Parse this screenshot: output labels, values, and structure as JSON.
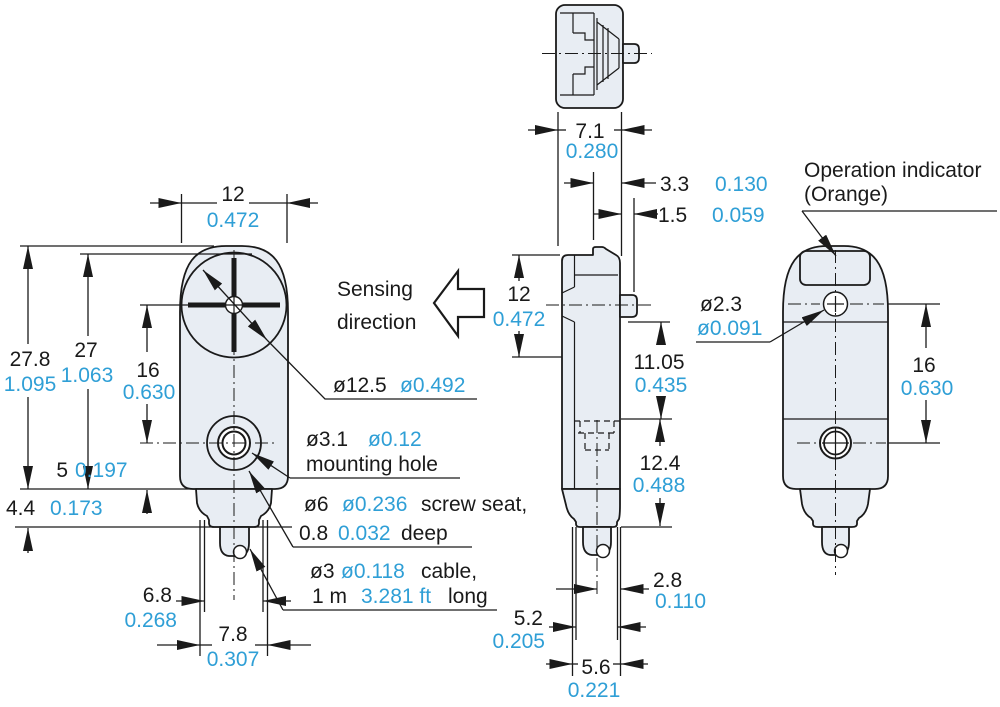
{
  "colors": {
    "mm_text": "#1a1a1a",
    "inch_text": "#2f9fd6",
    "body_fill": "#e8edf3",
    "line": "#1a1a1a",
    "background": "#ffffff"
  },
  "annotations": {
    "sensing_direction": {
      "line1": "Sensing",
      "line2": "direction"
    },
    "operation_indicator": {
      "line1": "Operation indicator",
      "line2": "(Orange)"
    },
    "lens_diameter": {
      "mm": "ø12.5",
      "inch": "ø0.492"
    },
    "mounting_hole": {
      "mm": "ø3.1",
      "inch": "ø0.12",
      "caption": "mounting hole"
    },
    "screw_seat": {
      "mm": "ø6",
      "inch": "ø0.236",
      "caption": "screw seat,",
      "depth_mm": "0.8",
      "depth_inch": "0.032",
      "depth_caption": "deep"
    },
    "cable": {
      "mm": "ø3",
      "inch": "ø0.118",
      "caption": "cable,",
      "length_mm": "1 m",
      "length_inch": "3.281 ft",
      "length_caption": "long"
    },
    "indicator_hole": {
      "mm": "ø2.3",
      "inch": "ø0.091"
    }
  },
  "dimensions": {
    "front_width": {
      "mm": "12",
      "inch": "0.472"
    },
    "front_overall_height": {
      "mm": "27.8",
      "inch": "1.095"
    },
    "front_body_height": {
      "mm": "27",
      "inch": "1.063"
    },
    "front_lens_to_hole": {
      "mm": "16",
      "inch": "0.630"
    },
    "front_hole_to_bottom": {
      "mm": "5",
      "inch": "0.197"
    },
    "front_neck_height": {
      "mm": "4.4",
      "inch": "0.173"
    },
    "front_cable_width_inner": {
      "mm": "6.8",
      "inch": "0.268"
    },
    "front_cable_width_outer": {
      "mm": "7.8",
      "inch": "0.307"
    },
    "top_depth": {
      "mm": "7.1",
      "inch": "0.280"
    },
    "top_lens_depth": {
      "mm": "3.3",
      "inch": "0.130"
    },
    "top_tip_depth": {
      "mm": "1.5",
      "inch": "0.059"
    },
    "side_upper_height": {
      "mm": "12",
      "inch": "0.472"
    },
    "side_middle_height": {
      "mm": "11.05",
      "inch": "0.435"
    },
    "side_lower_height": {
      "mm": "12.4",
      "inch": "0.488"
    },
    "side_cable_offset": {
      "mm": "2.8",
      "inch": "0.110"
    },
    "side_cable_width_inner": {
      "mm": "5.2",
      "inch": "0.205"
    },
    "side_cable_width_outer": {
      "mm": "5.6",
      "inch": "0.221"
    },
    "back_hole_distance": {
      "mm": "16",
      "inch": "0.630"
    }
  }
}
